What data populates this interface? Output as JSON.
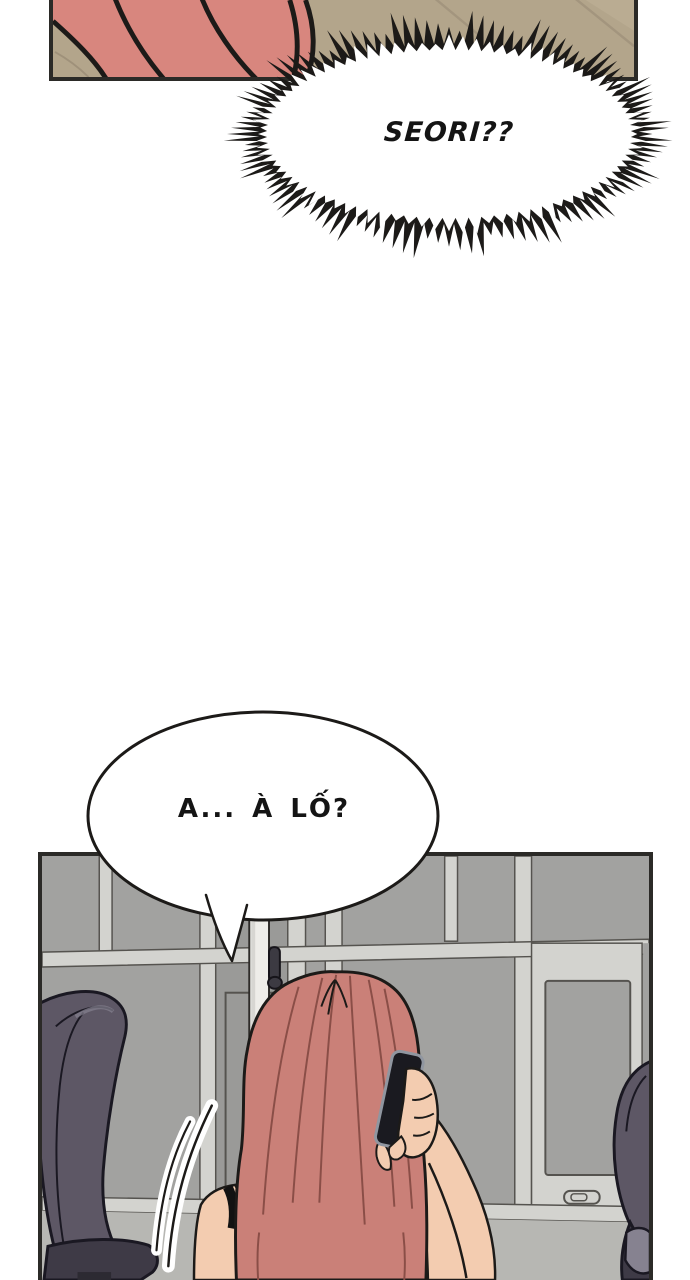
{
  "bubbles": {
    "shout": {
      "text": "SEORI??",
      "shape": "spiky-ellipse",
      "cx": 244,
      "cy": 134,
      "outer": {
        "rx": 190,
        "ry": 90,
        "amp": 30,
        "n": 120
      },
      "inner": {
        "rx": 182,
        "ry": 84,
        "amp": 14,
        "n": 88
      }
    },
    "speech": {
      "text": "A... À LỐ?",
      "shape": "oval-with-tail"
    }
  },
  "colors": {
    "page_bg": "#ffffff",
    "panel_border": "#2b2a27",
    "ink": "#1c1a18",
    "text_ink": "#141414",
    "bubble_fill": "#ffffff",
    "tan": "#b3a58b",
    "tan_shadow": "#9f917a",
    "tan_light": "#beb098",
    "pink": "#d8867e",
    "wall": "#a7a7a5",
    "pane": "#a2a2a0",
    "pane_dark": "#9a9a98",
    "frame": "#d3d3cf",
    "frame_line": "#55534f",
    "lower_wall": "#b7b7b3",
    "pillar": "#eeede9",
    "pillar_shade": "#d7d6d2",
    "handle_dark": "#3c3a42",
    "hair": "#ca8078",
    "hair_line": "#8a4e47",
    "skin": "#f3ccb0",
    "chair": "#5d5765",
    "chair_dark": "#3e3a46",
    "chair_light": "#868290",
    "chair_line": "#1a1822",
    "phone_body": "#1a1a20",
    "phone_edge": "#9096a0",
    "strap": "#121212"
  }
}
